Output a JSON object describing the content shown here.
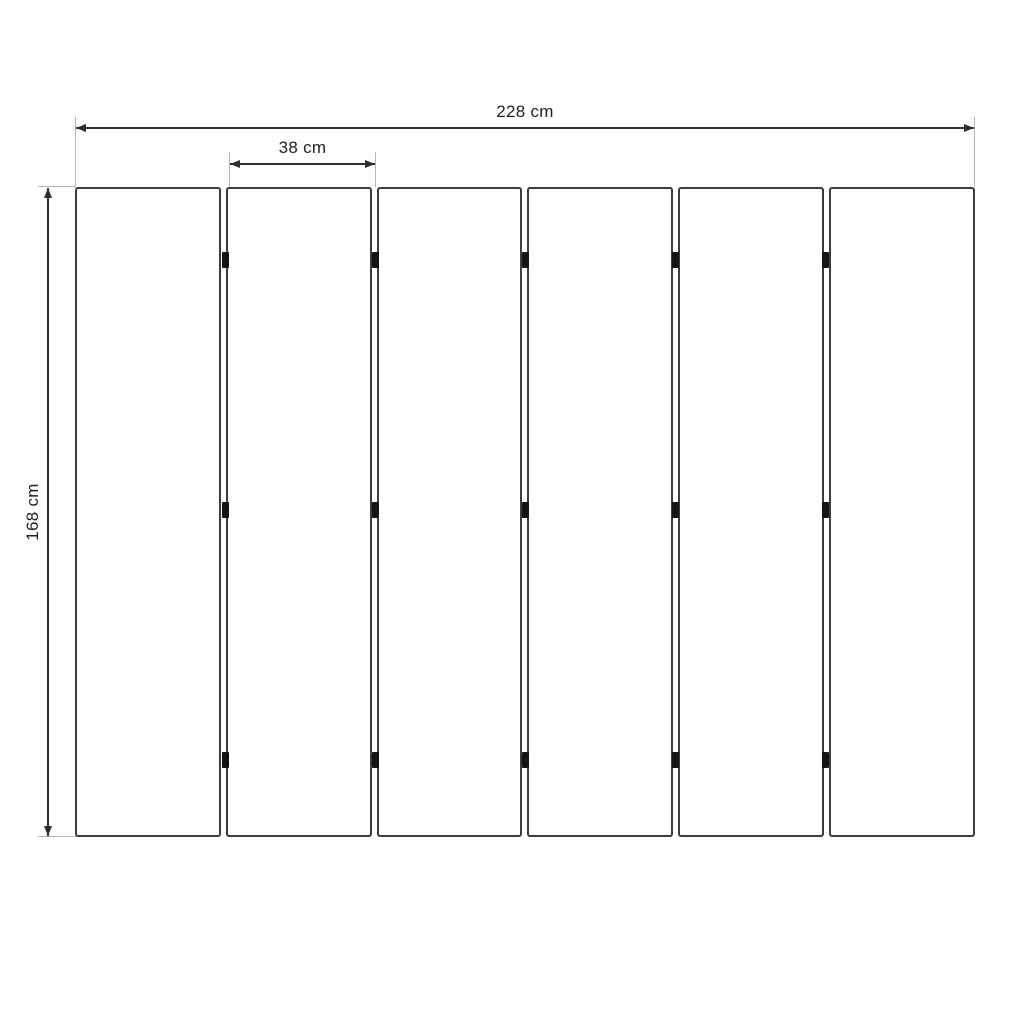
{
  "diagram": {
    "panel_count": 6,
    "connectors_per_gap": 3,
    "dimensions": {
      "total_width_label": "228 cm",
      "panel_width_label": "38 cm",
      "height_label": "168 cm"
    },
    "colors": {
      "background": "#ffffff",
      "panel_border": "#3d3d3d",
      "dimension_line": "#2e2e2e",
      "extension_line": "#b5b5b5",
      "connector": "#141414",
      "text": "#1f1f1f"
    }
  }
}
